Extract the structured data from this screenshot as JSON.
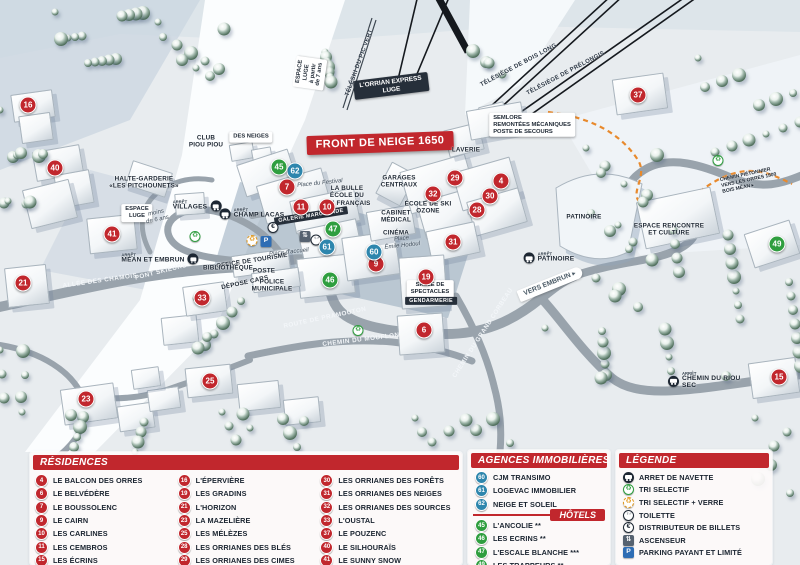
{
  "colors": {
    "red": "#c1272d",
    "agency": "#2e86ad",
    "hotel": "#2f9e3f",
    "parking": "#2e6db4",
    "dark": "#1d2733",
    "trail": "#e8892c"
  },
  "map": {
    "arret_word": "ARRÊT",
    "markers": [
      {
        "n": "16",
        "x": 28,
        "y": 105,
        "c": "r"
      },
      {
        "n": "40",
        "x": 55,
        "y": 168,
        "c": "r"
      },
      {
        "n": "41",
        "x": 112,
        "y": 234,
        "c": "r"
      },
      {
        "n": "21",
        "x": 23,
        "y": 283,
        "c": "r"
      },
      {
        "n": "23",
        "x": 86,
        "y": 399,
        "c": "r"
      },
      {
        "n": "25",
        "x": 210,
        "y": 381,
        "c": "r"
      },
      {
        "n": "33",
        "x": 202,
        "y": 298,
        "c": "r"
      },
      {
        "n": "7",
        "x": 287,
        "y": 187,
        "c": "r"
      },
      {
        "n": "11",
        "x": 301,
        "y": 207,
        "c": "r"
      },
      {
        "n": "10",
        "x": 327,
        "y": 207,
        "c": "r"
      },
      {
        "n": "9",
        "x": 376,
        "y": 264,
        "c": "r"
      },
      {
        "n": "29",
        "x": 455,
        "y": 178,
        "c": "r"
      },
      {
        "n": "32",
        "x": 433,
        "y": 194,
        "c": "r"
      },
      {
        "n": "4",
        "x": 501,
        "y": 181,
        "c": "r"
      },
      {
        "n": "30",
        "x": 490,
        "y": 196,
        "c": "r"
      },
      {
        "n": "28",
        "x": 477,
        "y": 210,
        "c": "r"
      },
      {
        "n": "31",
        "x": 453,
        "y": 242,
        "c": "r"
      },
      {
        "n": "19",
        "x": 426,
        "y": 277,
        "c": "r"
      },
      {
        "n": "6",
        "x": 424,
        "y": 330,
        "c": "r"
      },
      {
        "n": "37",
        "x": 638,
        "y": 95,
        "c": "r"
      },
      {
        "n": "15",
        "x": 779,
        "y": 377,
        "c": "r"
      },
      {
        "n": "62",
        "x": 295,
        "y": 171,
        "c": "a"
      },
      {
        "n": "61",
        "x": 327,
        "y": 247,
        "c": "a"
      },
      {
        "n": "60",
        "x": 374,
        "y": 252,
        "c": "a"
      },
      {
        "n": "45",
        "x": 279,
        "y": 167,
        "c": "h"
      },
      {
        "n": "47",
        "x": 333,
        "y": 229,
        "c": "h"
      },
      {
        "n": "46",
        "x": 330,
        "y": 280,
        "c": "h"
      },
      {
        "n": "49",
        "x": 777,
        "y": 244,
        "c": "h"
      }
    ],
    "labels": [
      {
        "t": "FRONT DE NEIGE 1650",
        "x": 380,
        "y": 143,
        "s": "red",
        "r": -2
      },
      {
        "t": "L'ORRIAN EXPRESS\nLUGE",
        "x": 391,
        "y": 86,
        "s": "dark",
        "r": -7
      },
      {
        "t": "SEMLORE\nREMONTÉES MÉCANIQUES\nPOSTE DE SECOURS",
        "x": 532,
        "y": 125,
        "s": "wbl",
        "r": 0
      },
      {
        "t": "TÉLÉSIÈGE DE BOIS LONG",
        "x": 519,
        "y": 66,
        "s": "lf",
        "r": -28
      },
      {
        "t": "TÉLÉSIÈGE DE PRÉLONGIS",
        "x": 566,
        "y": 74,
        "s": "lf",
        "r": -28
      },
      {
        "t": "TÉLÉSKI DU PIC VERT",
        "x": 360,
        "y": 63,
        "s": "lf",
        "r": -70
      },
      {
        "t": "ESPACE\nLUGE\nà partir\nde 7 ans",
        "x": 310,
        "y": 73,
        "s": "wb",
        "r": -82
      },
      {
        "t": "ESPACE\nLUGE",
        "x": 137,
        "y": 213,
        "s": "wb",
        "r": 0
      },
      {
        "t": "moins\nde 6 ans",
        "x": 157,
        "y": 217,
        "s": "pl",
        "r": -12
      },
      {
        "t": "CLUB\nPIOU PIOU",
        "x": 206,
        "y": 142,
        "s": "nm",
        "r": 0
      },
      {
        "t": "DES NEIGES",
        "x": 251,
        "y": 137,
        "s": "wb",
        "r": 0
      },
      {
        "t": "HALTE-GARDERIE\n«LES PITCHOUNETS»",
        "x": 144,
        "y": 183,
        "s": "nm",
        "r": 0
      },
      {
        "t": "LA BULLE\nÉCOLE DU\nSKI FRANÇAIS",
        "x": 347,
        "y": 196,
        "s": "nm",
        "r": 0
      },
      {
        "t": "GARAGES\nCENTRAUX",
        "x": 399,
        "y": 182,
        "s": "nm",
        "r": 0
      },
      {
        "t": "LAVERIE",
        "x": 466,
        "y": 150,
        "s": "nm",
        "r": 0
      },
      {
        "t": "CABINET\nMÉDICAL",
        "x": 396,
        "y": 217,
        "s": "nm",
        "r": 0
      },
      {
        "t": "CINÉMA",
        "x": 396,
        "y": 233,
        "s": "nm",
        "r": 0
      },
      {
        "t": "ÉCOLE DE SKI\nOZONE",
        "x": 428,
        "y": 208,
        "s": "nm",
        "r": 0
      },
      {
        "t": "Place du Festival",
        "x": 320,
        "y": 184,
        "s": "pl",
        "r": -6
      },
      {
        "t": "Place d'accueil",
        "x": 289,
        "y": 253,
        "s": "pl",
        "r": -6
      },
      {
        "t": "Place\nÉmile Hodoul",
        "x": 402,
        "y": 243,
        "s": "pl",
        "r": -6
      },
      {
        "t": "GALERIE MARCHANDE",
        "x": 311,
        "y": 216,
        "s": "ds",
        "r": -9
      },
      {
        "t": "OFFICE DE TOURISME",
        "x": 252,
        "y": 261,
        "s": "nm",
        "r": -9
      },
      {
        "t": "BIBLIOTHÈQUE",
        "x": 228,
        "y": 268,
        "s": "nm",
        "r": 0
      },
      {
        "t": "POSTE",
        "x": 264,
        "y": 271,
        "s": "nm",
        "r": 0
      },
      {
        "t": "DÉPOSE CARS",
        "x": 245,
        "y": 283,
        "s": "nm",
        "r": -12
      },
      {
        "t": "POLICE\nMUNICIPALE",
        "x": 272,
        "y": 286,
        "s": "nm",
        "r": 0
      },
      {
        "t": "SALLE DE\nSPECTACLES",
        "x": 430,
        "y": 289,
        "s": "wb",
        "r": 0
      },
      {
        "t": "GENDARMERIE",
        "x": 431,
        "y": 301,
        "s": "ds",
        "r": 0
      },
      {
        "t": "ALLÉE DES CHAMOIS",
        "x": 100,
        "y": 281,
        "s": "rd",
        "r": -8
      },
      {
        "t": "PONT SKIEURS",
        "x": 161,
        "y": 272,
        "s": "rd",
        "r": -14
      },
      {
        "t": "ROUTE DE PRAMOUTON",
        "x": 325,
        "y": 318,
        "s": "rd",
        "r": -12
      },
      {
        "t": "CHEMIN DU MOUFLON",
        "x": 361,
        "y": 340,
        "s": "rd",
        "r": -7
      },
      {
        "t": "CHEMIN DU GRAND CORBEAU",
        "x": 483,
        "y": 333,
        "s": "rd",
        "r": -57
      },
      {
        "t": "VERS EMBRUN ▸",
        "x": 550,
        "y": 284,
        "s": "vb",
        "r": -22
      },
      {
        "t": "PATINOIRE",
        "x": 584,
        "y": 217,
        "s": "nm",
        "r": 0
      },
      {
        "t": "ESPACE RENCONTRE\nET CULTURE",
        "x": 669,
        "y": 230,
        "s": "nm",
        "r": 0
      },
      {
        "t": "CHEMIN PIÉTONNIER\nVERS LES ORRES 1800\nBOIS MÉAN ▸",
        "x": 749,
        "y": 181,
        "s": "td",
        "r": -12
      }
    ],
    "arrets": [
      {
        "t": "VILLAGES",
        "x": 197,
        "y": 206,
        "icon": "right"
      },
      {
        "t": "CHAMP LACAS",
        "x": 252,
        "y": 214,
        "icon": "left"
      },
      {
        "t": "MÉAN ET EMBRUN",
        "x": 160,
        "y": 259,
        "icon": "right"
      },
      {
        "t": "PATINOIRE",
        "x": 549,
        "y": 258,
        "icon": "left"
      },
      {
        "t": "CHEMIN DU RIOU SEC",
        "x": 712,
        "y": 381,
        "icon": "left"
      }
    ],
    "icons": [
      {
        "k": "recycle-green",
        "x": 195,
        "y": 233
      },
      {
        "k": "recycle-green",
        "x": 358,
        "y": 327
      },
      {
        "k": "recycle-green",
        "x": 718,
        "y": 157
      },
      {
        "k": "recycle-yellow",
        "x": 252,
        "y": 237
      },
      {
        "k": "parking",
        "x": 266,
        "y": 238
      },
      {
        "k": "euro",
        "x": 273,
        "y": 224
      },
      {
        "k": "toilet",
        "x": 316,
        "y": 236
      },
      {
        "k": "elevator",
        "x": 305,
        "y": 233
      }
    ],
    "buildings": [
      [
        12,
        92,
        40,
        26,
        -8
      ],
      [
        20,
        114,
        30,
        26,
        -8
      ],
      [
        34,
        148,
        46,
        28,
        -10
      ],
      [
        56,
        172,
        34,
        32,
        -10
      ],
      [
        26,
        184,
        46,
        38,
        -14
      ],
      [
        128,
        166,
        40,
        24,
        18
      ],
      [
        88,
        216,
        46,
        34,
        -6
      ],
      [
        6,
        266,
        40,
        38,
        -6
      ],
      [
        62,
        386,
        52,
        34,
        -8
      ],
      [
        118,
        404,
        34,
        24,
        -8
      ],
      [
        148,
        388,
        30,
        20,
        -8
      ],
      [
        132,
        368,
        26,
        18,
        -8
      ],
      [
        186,
        366,
        44,
        28,
        -6
      ],
      [
        238,
        382,
        40,
        26,
        -6
      ],
      [
        284,
        398,
        34,
        24,
        -6
      ],
      [
        162,
        316,
        34,
        26,
        -6
      ],
      [
        230,
        143,
        22,
        15,
        -10
      ],
      [
        252,
        148,
        18,
        13,
        -10
      ],
      [
        175,
        193,
        28,
        20,
        -4
      ],
      [
        240,
        156,
        52,
        32,
        -18
      ],
      [
        260,
        176,
        66,
        38,
        -16
      ],
      [
        292,
        194,
        64,
        32,
        -12
      ],
      [
        300,
        224,
        58,
        32,
        -12
      ],
      [
        298,
        256,
        54,
        38,
        -6
      ],
      [
        344,
        234,
        52,
        42,
        -8
      ],
      [
        368,
        208,
        44,
        28,
        -10
      ],
      [
        382,
        166,
        26,
        34,
        28
      ],
      [
        404,
        162,
        66,
        42,
        -16
      ],
      [
        420,
        194,
        58,
        36,
        -16
      ],
      [
        456,
        164,
        58,
        38,
        -16
      ],
      [
        470,
        194,
        52,
        34,
        -16
      ],
      [
        428,
        226,
        48,
        30,
        -12
      ],
      [
        400,
        256,
        44,
        50,
        -4
      ],
      [
        398,
        314,
        44,
        38,
        -4
      ],
      [
        446,
        126,
        34,
        26,
        -14
      ],
      [
        480,
        104,
        24,
        18,
        -14
      ],
      [
        614,
        76,
        50,
        34,
        -8
      ],
      [
        468,
        106,
        54,
        28,
        -10
      ],
      [
        640,
        194,
        74,
        46,
        -12
      ],
      [
        748,
        226,
        46,
        34,
        -18
      ],
      [
        750,
        360,
        46,
        34,
        -8
      ],
      [
        232,
        252,
        56,
        20,
        -8
      ],
      [
        252,
        270,
        46,
        18,
        -8
      ],
      [
        184,
        284,
        40,
        28,
        -8
      ]
    ],
    "trees": [
      [
        55,
        12,
        95,
        70,
        14
      ],
      [
        158,
        22,
        75,
        55,
        10
      ],
      [
        0,
        110,
        48,
        95,
        10
      ],
      [
        325,
        52,
        60,
        42,
        7
      ],
      [
        196,
        298,
        52,
        58,
        8
      ],
      [
        22,
        412,
        125,
        42,
        10
      ],
      [
        222,
        412,
        115,
        40,
        9
      ],
      [
        415,
        418,
        105,
        35,
        8
      ],
      [
        586,
        148,
        75,
        170,
        16
      ],
      [
        618,
        225,
        185,
        155,
        24
      ],
      [
        698,
        58,
        105,
        100,
        13
      ],
      [
        545,
        328,
        62,
        58,
        7
      ],
      [
        755,
        418,
        45,
        80,
        7
      ],
      [
        470,
        50,
        45,
        35,
        5
      ],
      [
        0,
        350,
        40,
        70,
        6
      ]
    ]
  },
  "panels": {
    "residences": {
      "title": "RÉSIDENCES",
      "cols": [
        [
          {
            "n": "4",
            "t": "LE BALCON DES ORRES"
          },
          {
            "n": "6",
            "t": "LE BELVÉDÈRE"
          },
          {
            "n": "7",
            "t": "LE BOUSSOLENC"
          },
          {
            "n": "9",
            "t": "LE CAIRN"
          },
          {
            "n": "10",
            "t": "LES CARLINES"
          },
          {
            "n": "11",
            "t": "LES CEMBROS"
          },
          {
            "n": "15",
            "t": "LES ÉCRINS"
          }
        ],
        [
          {
            "n": "16",
            "t": "L'ÉPERVIÈRE"
          },
          {
            "n": "19",
            "t": "LES GRADINS"
          },
          {
            "n": "21",
            "t": "L'HORIZON"
          },
          {
            "n": "23",
            "t": "LA MAZELIÈRE"
          },
          {
            "n": "25",
            "t": "LES MÉLÈZES"
          },
          {
            "n": "28",
            "t": "LES ORRIANES DES BLÉS"
          },
          {
            "n": "29",
            "t": "LES ORRIANES DES CIMES"
          }
        ],
        [
          {
            "n": "30",
            "t": "LES ORRIANES DES FORÊTS"
          },
          {
            "n": "31",
            "t": "LES ORRIANES DES NEIGES"
          },
          {
            "n": "32",
            "t": "LES ORRIANES DES SOURCES"
          },
          {
            "n": "33",
            "t": "L'OUSTAL"
          },
          {
            "n": "37",
            "t": "LE POUZENC"
          },
          {
            "n": "40",
            "t": "LE SILHOURAÏS"
          },
          {
            "n": "41",
            "t": "LE SUNNY SNOW"
          }
        ]
      ]
    },
    "agences": {
      "title": "AGENCES IMMOBILIÈRES",
      "items": [
        {
          "n": "60",
          "t": "CJM TRANSIMO"
        },
        {
          "n": "61",
          "t": "LOGEVAC IMMOBILIER"
        },
        {
          "n": "62",
          "t": "NEIGE ET SOLEIL"
        }
      ]
    },
    "hotels": {
      "title": "HÔTELS",
      "items": [
        {
          "n": "45",
          "t": "L'ANCOLIE **"
        },
        {
          "n": "46",
          "t": "LES ECRINS **"
        },
        {
          "n": "47",
          "t": "L'ESCALE BLANCHE ***"
        },
        {
          "n": "49",
          "t": "LES TRAPPEURS **"
        }
      ]
    },
    "legende": {
      "title": "LÉGENDE",
      "items": [
        {
          "icon": "bus",
          "t": "ARRET DE NAVETTE"
        },
        {
          "icon": "recycle-green",
          "t": "TRI SELECTIF"
        },
        {
          "icon": "recycle-yellow",
          "t": "TRI SELECTIF + VERRE"
        },
        {
          "icon": "toilet",
          "t": "TOILETTE"
        },
        {
          "icon": "euro",
          "t": "DISTRIBUTEUR DE BILLETS"
        },
        {
          "icon": "elevator",
          "t": "ASCENSEUR"
        },
        {
          "icon": "parking",
          "t": "PARKING PAYANT ET LIMITÉ"
        }
      ]
    }
  }
}
